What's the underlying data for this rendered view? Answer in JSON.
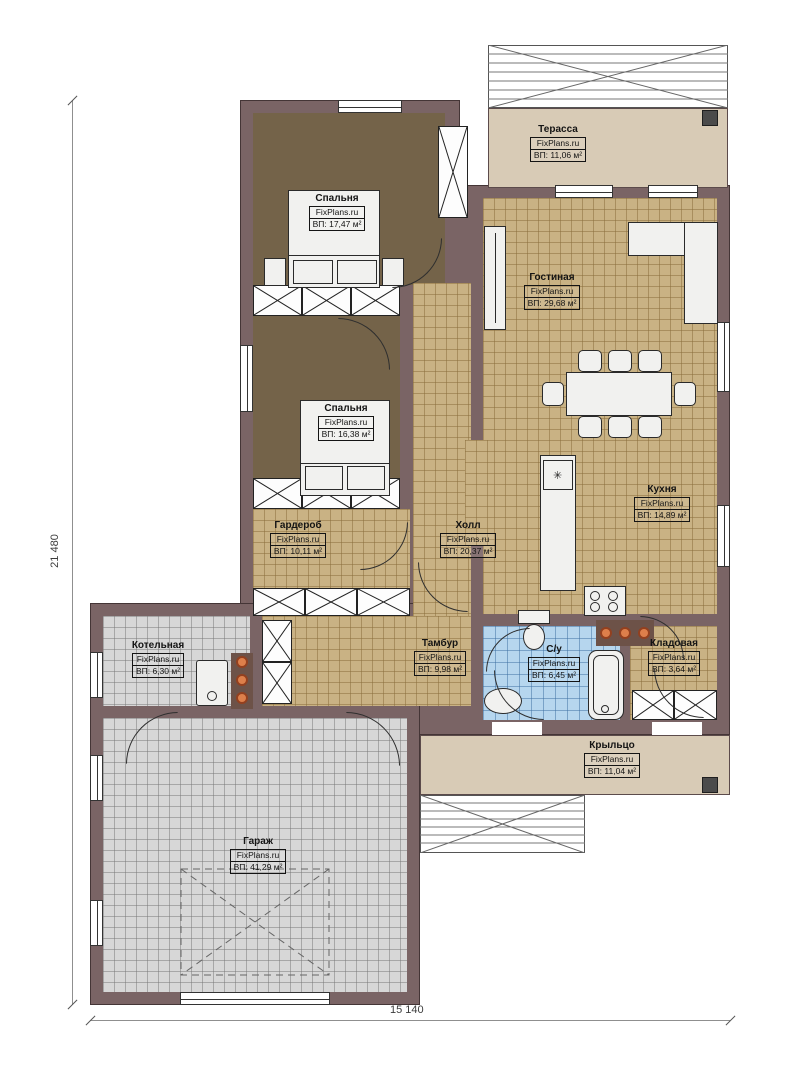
{
  "site": "FixPlans.ru",
  "dimensions": {
    "vertical": "21 480",
    "horizontal": "15 140"
  },
  "rooms": [
    {
      "id": "terrace",
      "name": "Терасса",
      "site": "FixPlans.ru",
      "area": "ВП: 11,06 м²"
    },
    {
      "id": "bedroom1",
      "name": "Спальня",
      "site": "FixPlans.ru",
      "area": "ВП: 17,47 м²"
    },
    {
      "id": "living",
      "name": "Гостиная",
      "site": "FixPlans.ru",
      "area": "ВП: 29,68 м²"
    },
    {
      "id": "bedroom2",
      "name": "Спальня",
      "site": "FixPlans.ru",
      "area": "ВП: 16,38 м²"
    },
    {
      "id": "wardrobe",
      "name": "Гардероб",
      "site": "FixPlans.ru",
      "area": "ВП: 10,11 м²"
    },
    {
      "id": "hall",
      "name": "Холл",
      "site": "FixPlans.ru",
      "area": "ВП: 20,37 м²"
    },
    {
      "id": "kitchen",
      "name": "Кухня",
      "site": "FixPlans.ru",
      "area": "ВП: 14,89 м²"
    },
    {
      "id": "boiler",
      "name": "Котельная",
      "site": "FixPlans.ru",
      "area": "ВП: 6,30 м²"
    },
    {
      "id": "vestibule",
      "name": "Тамбур",
      "site": "FixPlans.ru",
      "area": "ВП: 9,98 м²"
    },
    {
      "id": "bathroom",
      "name": "С/у",
      "site": "FixPlans.ru",
      "area": "ВП: 6,45 м²"
    },
    {
      "id": "pantry",
      "name": "Кладовая",
      "site": "FixPlans.ru",
      "area": "ВП: 3,64 м²"
    },
    {
      "id": "porch",
      "name": "Крыльцо",
      "site": "FixPlans.ru",
      "area": "ВП: 11,04 м²"
    },
    {
      "id": "garage",
      "name": "Гараж",
      "site": "FixPlans.ru",
      "area": "ВП: 41,29 м²"
    }
  ]
}
